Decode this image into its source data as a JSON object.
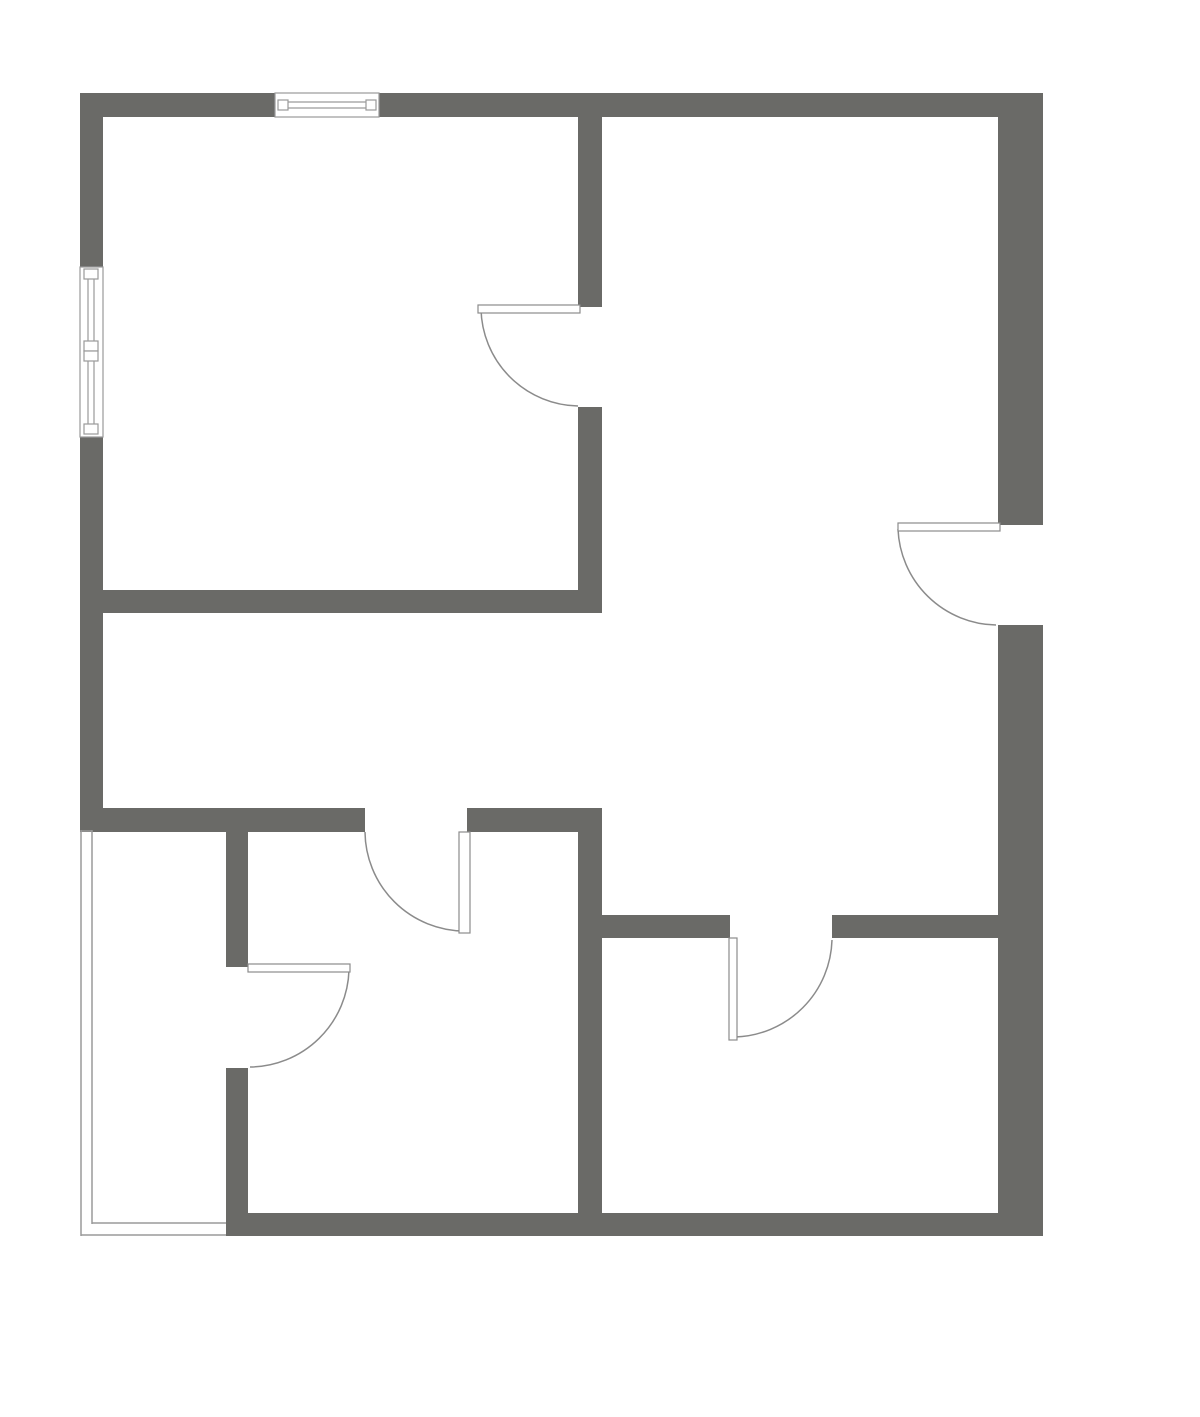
{
  "document": {
    "kind": "architectural-floor-plan",
    "visible_text": []
  },
  "canvas": {
    "width": 1200,
    "height": 1417,
    "background": "#ffffff"
  },
  "colors": {
    "wall_fill": "#6a6a67",
    "door_arc_stroke": "#8b8b8b",
    "door_leaf_stroke": "#8b8b8b",
    "door_leaf_fill": "#ffffff",
    "window_stroke": "#9a9a9a",
    "window_fill": "#ffffff",
    "glazing_stroke": "#9a9a9a"
  },
  "stroke_widths": {
    "door_arc": 1.5,
    "door_leaf": 1.2,
    "window": 1.2,
    "glazing": 1.5
  },
  "walls": [
    {
      "name": "top-wall-left-of-window",
      "rect": [
        80,
        93,
        195,
        24
      ]
    },
    {
      "name": "top-wall-right-of-window",
      "rect": [
        379,
        93,
        664,
        24
      ]
    },
    {
      "name": "left-wall-above-window",
      "rect": [
        80,
        93,
        23,
        174
      ]
    },
    {
      "name": "left-wall-below-window",
      "rect": [
        80,
        437,
        23,
        393
      ]
    },
    {
      "name": "right-wall-above-door",
      "rect": [
        998,
        93,
        45,
        432
      ]
    },
    {
      "name": "right-wall-below-door",
      "rect": [
        998,
        625,
        45,
        611
      ]
    },
    {
      "name": "bottom-wall",
      "rect": [
        248,
        1213,
        795,
        23
      ]
    },
    {
      "name": "upper-left-room-south-wall",
      "rect": [
        80,
        590,
        522,
        23
      ]
    },
    {
      "name": "upper-divider-above-door",
      "rect": [
        578,
        117,
        24,
        190
      ]
    },
    {
      "name": "upper-divider-below-door",
      "rect": [
        578,
        407,
        24,
        206
      ]
    },
    {
      "name": "living-south-wall-west-of-door",
      "rect": [
        80,
        808,
        285,
        24
      ]
    },
    {
      "name": "living-south-wall-east-of-door",
      "rect": [
        467,
        808,
        135,
        24
      ]
    },
    {
      "name": "balcony-divider-above-door",
      "rect": [
        226,
        808,
        22,
        159
      ]
    },
    {
      "name": "balcony-divider-below-door",
      "rect": [
        226,
        1068,
        22,
        168
      ]
    },
    {
      "name": "center-divider-wall",
      "rect": [
        578,
        832,
        24,
        404
      ]
    },
    {
      "name": "lower-right-room-wall-west-of-door",
      "rect": [
        602,
        915,
        128,
        23
      ]
    },
    {
      "name": "lower-right-room-wall-east-of-door",
      "rect": [
        832,
        915,
        166,
        23
      ]
    }
  ],
  "windows": [
    {
      "name": "top-window",
      "rect": [
        275,
        93,
        104,
        24
      ],
      "panes": [
        [
          278,
          102,
          376,
          102
        ],
        [
          278,
          108,
          376,
          108
        ]
      ],
      "ticks": [
        [
          278,
          100,
          10,
          10
        ],
        [
          366,
          100,
          10,
          10
        ]
      ]
    },
    {
      "name": "left-window",
      "rect": [
        80,
        267,
        23,
        170
      ],
      "panes": [
        [
          88,
          271,
          88,
          433
        ],
        [
          94,
          271,
          94,
          433
        ]
      ],
      "ticks": [
        [
          84,
          269,
          14,
          10
        ],
        [
          84,
          424,
          14,
          10
        ],
        [
          84,
          341,
          14,
          10
        ],
        [
          84,
          351,
          14,
          10
        ]
      ]
    }
  ],
  "glazing": {
    "name": "balcony-glazing",
    "lines": [
      [
        81,
        830,
        81,
        1236
      ],
      [
        92,
        830,
        92,
        1224
      ],
      [
        81,
        1235,
        226,
        1235
      ],
      [
        92,
        1223,
        226,
        1223
      ],
      [
        81,
        831,
        92,
        831
      ]
    ]
  },
  "doors": [
    {
      "name": "upper-left-room-door",
      "leaf": [
        478,
        305,
        102,
        8
      ],
      "arc": "M 481 309 A 99 99 0 0 0 578 406"
    },
    {
      "name": "right-room-door",
      "leaf": [
        898,
        523,
        102,
        8
      ],
      "arc": "M 898 529 A 100 100 0 0 0 996 625"
    },
    {
      "name": "lower-middle-room-door",
      "leaf": [
        459,
        832,
        11,
        101
      ],
      "arc": "M 365 832 A 100 100 0 0 0 464 931"
    },
    {
      "name": "balcony-hall-door",
      "leaf": [
        248,
        964,
        102,
        8
      ],
      "arc": "M 349 970 A 100 100 0 0 1 250 1067"
    },
    {
      "name": "lower-right-room-door",
      "leaf": [
        729,
        938,
        8,
        102
      ],
      "arc": "M 832 940 A 100 100 0 0 1 735 1037"
    }
  ]
}
